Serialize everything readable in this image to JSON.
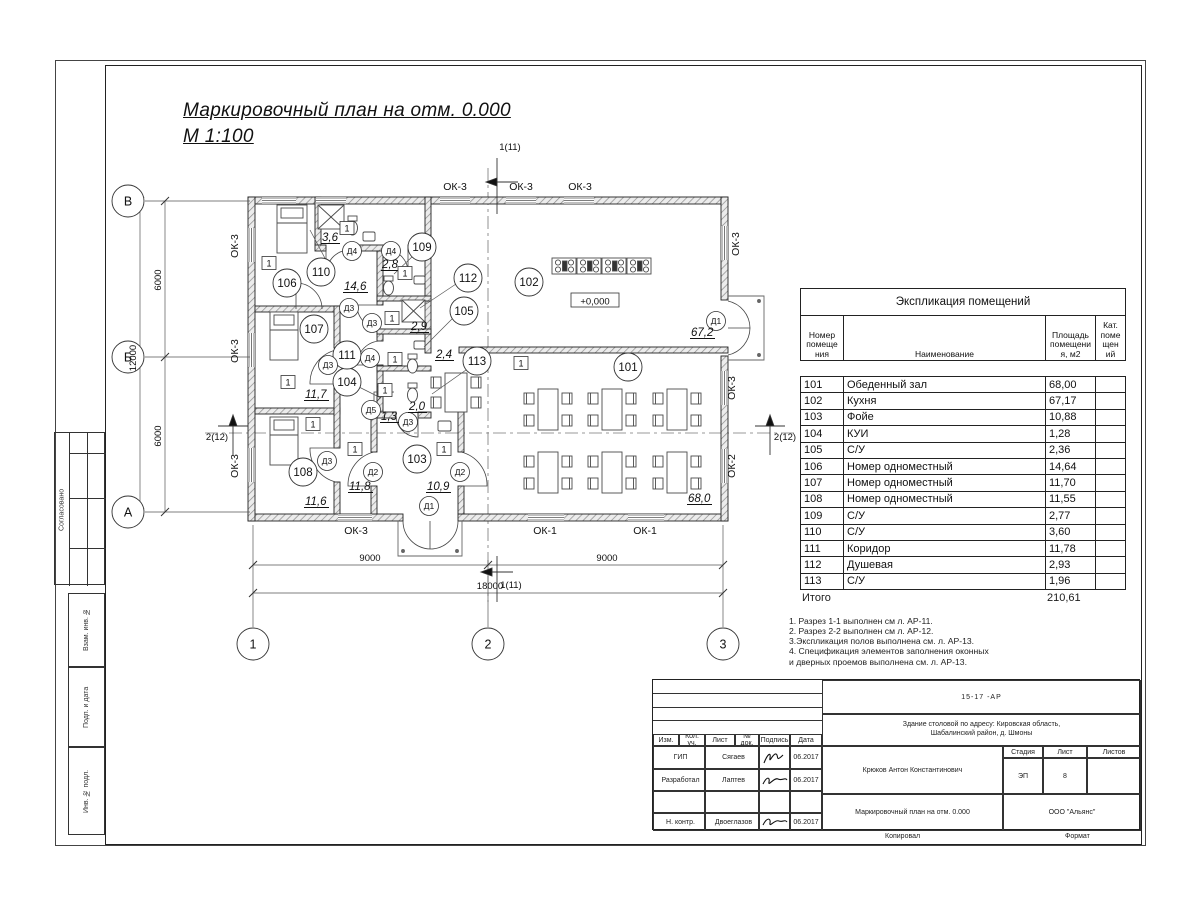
{
  "sheet_title": {
    "line1": "Маркировочный план  на отм. 0.000",
    "line2": "М 1:100"
  },
  "side_stamps": {
    "approve": "Согласовано",
    "vzam": "Взам. инв. №",
    "podp": "Подп. и дата",
    "inv": "Инв. № подл."
  },
  "footer": {
    "kopiroval": "Копировал",
    "format": "Формат"
  },
  "exploration_table": {
    "title": "Экспликация помещений",
    "col_number": "Номер\nпомеще\nния",
    "col_name": "Наименование",
    "col_area": "Площадь\nпомещени\nя, м2",
    "col_cat": "Кат.\nпоме\nщен\nий",
    "rows": [
      {
        "num": "101",
        "name": "Обеденный зал",
        "area": "68,00"
      },
      {
        "num": "102",
        "name": "Кухня",
        "area": "67,17"
      },
      {
        "num": "103",
        "name": "Фойе",
        "area": "10,88"
      },
      {
        "num": "104",
        "name": "КУИ",
        "area": "1,28"
      },
      {
        "num": "105",
        "name": "С/У",
        "area": "2,36"
      },
      {
        "num": "106",
        "name": "Номер одноместный",
        "area": "14,64"
      },
      {
        "num": "107",
        "name": "Номер одноместный",
        "area": "11,70"
      },
      {
        "num": "108",
        "name": "Номер одноместный",
        "area": "11,55"
      },
      {
        "num": "109",
        "name": "С/У",
        "area": "2,77"
      },
      {
        "num": "110",
        "name": "С/У",
        "area": "3,60"
      },
      {
        "num": "111",
        "name": "Коридор",
        "area": "11,78"
      },
      {
        "num": "112",
        "name": "Душевая",
        "area": "2,93"
      },
      {
        "num": "113",
        "name": "С/У",
        "area": "1,96"
      }
    ],
    "total_label": "Итого",
    "total_value": "210,61"
  },
  "notes": [
    "1. Разрез 1-1 выполнен см л. АР-11.",
    "2. Разрез 2-2 выполнен см л. АР-12.",
    "3.Экспликация полов выполнена  см. л. АР-13.",
    "4. Спецификация элементов заполнения оконных",
    " и дверных проемов выполнена  см. л. АР-13."
  ],
  "title_block": {
    "code": "15-17 -АР",
    "object_line1": "Здание столовой по адресу: Кировская область,",
    "object_line2": "Шабалинский район, д. Шмоны",
    "person": "Крюков Антон Константинович",
    "doc_title": "Маркировочный план  на отм. 0.000",
    "org": "ООО \"Альянс\"",
    "stage_label": "Стадия",
    "stage": "ЭП",
    "sheet_label": "Лист",
    "sheet": "8",
    "sheets_label": "Листов",
    "col_izm": "Изм.",
    "col_kol": "Кол. уч.",
    "col_list": "Лист",
    "col_ndok": "№ док.",
    "col_podpis": "Подпись",
    "col_data": "Дата",
    "roles": [
      {
        "role": "ГИП",
        "name": "Сягаев",
        "date": "06.2017"
      },
      {
        "role": "Разработал",
        "name": "Лаптев",
        "date": "06.2017"
      },
      {
        "role": "",
        "name": "",
        "date": ""
      },
      {
        "role": "Н. контр.",
        "name": "Двоеглазов",
        "date": "06.2017"
      }
    ]
  },
  "plan": {
    "room_circles": [
      {
        "n": "101",
        "x": 628,
        "y": 367
      },
      {
        "n": "102",
        "x": 529,
        "y": 282
      },
      {
        "n": "103",
        "x": 417,
        "y": 459
      },
      {
        "n": "104",
        "x": 347,
        "y": 382
      },
      {
        "n": "105",
        "x": 464,
        "y": 311
      },
      {
        "n": "106",
        "x": 287,
        "y": 283
      },
      {
        "n": "107",
        "x": 314,
        "y": 329
      },
      {
        "n": "108",
        "x": 303,
        "y": 472
      },
      {
        "n": "109",
        "x": 422,
        "y": 247
      },
      {
        "n": "110",
        "x": 321,
        "y": 272
      },
      {
        "n": "111",
        "x": 347,
        "y": 355
      },
      {
        "n": "112",
        "x": 468,
        "y": 278
      },
      {
        "n": "113",
        "x": 477,
        "y": 361
      }
    ],
    "door_tags": [
      {
        "n": "Д4",
        "x": 352,
        "y": 251
      },
      {
        "n": "Д4",
        "x": 391,
        "y": 251
      },
      {
        "n": "Д4",
        "x": 370,
        "y": 358
      },
      {
        "n": "Д3",
        "x": 349,
        "y": 308
      },
      {
        "n": "Д3",
        "x": 372,
        "y": 323
      },
      {
        "n": "Д3",
        "x": 328,
        "y": 365
      },
      {
        "n": "Д3",
        "x": 327,
        "y": 461
      },
      {
        "n": "Д3",
        "x": 408,
        "y": 422
      },
      {
        "n": "Д5",
        "x": 371,
        "y": 410
      },
      {
        "n": "Д2",
        "x": 373,
        "y": 472
      },
      {
        "n": "Д2",
        "x": 460,
        "y": 472
      },
      {
        "n": "Д1",
        "x": 429,
        "y": 506
      },
      {
        "n": "Д1",
        "x": 716,
        "y": 321
      }
    ],
    "area_labels": [
      {
        "t": "3,6",
        "x": 322,
        "y": 241
      },
      {
        "t": "14,6",
        "x": 344,
        "y": 290
      },
      {
        "t": "2,8",
        "x": 382,
        "y": 268
      },
      {
        "t": "2,9",
        "x": 411,
        "y": 330
      },
      {
        "t": "2,4",
        "x": 436,
        "y": 358
      },
      {
        "t": "1,3",
        "x": 381,
        "y": 420
      },
      {
        "t": "2,0",
        "x": 409,
        "y": 410
      },
      {
        "t": "11,7",
        "x": 305,
        "y": 398
      },
      {
        "t": "11,8",
        "x": 349,
        "y": 490
      },
      {
        "t": "10,9",
        "x": 427,
        "y": 490
      },
      {
        "t": "11,6",
        "x": 305,
        "y": 505
      },
      {
        "t": "67,2",
        "x": 691,
        "y": 336
      },
      {
        "t": "68,0",
        "x": 688,
        "y": 502
      }
    ],
    "unit_tags": [
      {
        "t": "1",
        "x": 269,
        "y": 263
      },
      {
        "t": "1",
        "x": 347,
        "y": 228
      },
      {
        "t": "1",
        "x": 405,
        "y": 273
      },
      {
        "t": "1",
        "x": 288,
        "y": 382
      },
      {
        "t": "1",
        "x": 392,
        "y": 318
      },
      {
        "t": "1",
        "x": 395,
        "y": 359
      },
      {
        "t": "1",
        "x": 385,
        "y": 390
      },
      {
        "t": "1",
        "x": 313,
        "y": 424
      },
      {
        "t": "1",
        "x": 355,
        "y": 449
      },
      {
        "t": "1",
        "x": 444,
        "y": 449
      },
      {
        "t": "1",
        "x": 521,
        "y": 363
      }
    ],
    "window_labels": [
      {
        "t": "ОК-3",
        "x": 455,
        "y": 190,
        "r": 0
      },
      {
        "t": "ОК-3",
        "x": 521,
        "y": 190,
        "r": 0
      },
      {
        "t": "ОК-3",
        "x": 580,
        "y": 190,
        "r": 0
      },
      {
        "t": "ОК-3",
        "x": 238,
        "y": 246,
        "r": 90
      },
      {
        "t": "ОК-3",
        "x": 238,
        "y": 351,
        "r": 90
      },
      {
        "t": "ОК-3",
        "x": 238,
        "y": 466,
        "r": 90
      },
      {
        "t": "ОК-3",
        "x": 739,
        "y": 244,
        "r": 90
      },
      {
        "t": "ОК-3",
        "x": 735,
        "y": 388,
        "r": 90
      },
      {
        "t": "ОК-2",
        "x": 735,
        "y": 466,
        "r": 90
      },
      {
        "t": "ОК-3",
        "x": 356,
        "y": 534,
        "r": 0
      },
      {
        "t": "ОК-1",
        "x": 545,
        "y": 534,
        "r": 0
      },
      {
        "t": "ОК-1",
        "x": 645,
        "y": 534,
        "r": 0
      }
    ],
    "axis_circles": [
      {
        "n": "В",
        "x": 128,
        "y": 201
      },
      {
        "n": "Б",
        "x": 128,
        "y": 357
      },
      {
        "n": "А",
        "x": 128,
        "y": 512
      },
      {
        "n": "1",
        "x": 253,
        "y": 644
      },
      {
        "n": "2",
        "x": 488,
        "y": 644
      },
      {
        "n": "3",
        "x": 723,
        "y": 644
      }
    ],
    "dim_labels": [
      {
        "t": "9000",
        "x": 370,
        "y": 561,
        "r": 0
      },
      {
        "t": "9000",
        "x": 607,
        "y": 561,
        "r": 0
      },
      {
        "t": "18000",
        "x": 490,
        "y": 589,
        "r": 0
      },
      {
        "t": "6000",
        "x": 161,
        "y": 280,
        "r": 90
      },
      {
        "t": "6000",
        "x": 161,
        "y": 436,
        "r": 90
      },
      {
        "t": "12000",
        "x": 136,
        "y": 358,
        "r": 90
      }
    ],
    "section_tags": [
      {
        "t": "1(11)",
        "x": 510,
        "y": 150
      },
      {
        "t": "1(11)",
        "x": 511,
        "y": 588
      },
      {
        "t": "2(12)",
        "x": 217,
        "y": 440
      },
      {
        "t": "2(12)",
        "x": 785,
        "y": 440
      }
    ],
    "elevation": {
      "t": "+0,000",
      "x": 595,
      "y": 302
    }
  }
}
